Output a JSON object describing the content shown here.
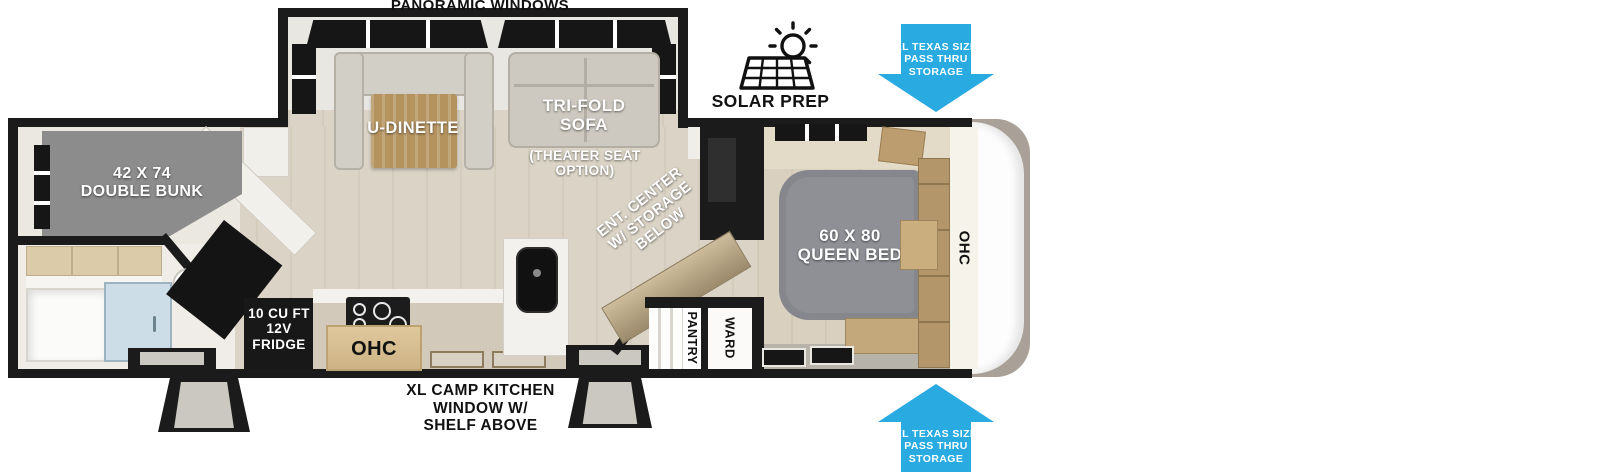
{
  "labels": {
    "panoramic_windows": "PANORAMIC WINDOWS",
    "solar_prep": "SOLAR PREP",
    "pass_thru": [
      "XL TEXAS SIZE",
      "PASS THRU",
      "STORAGE"
    ],
    "camp_kitchen": [
      "XL CAMP KITCHEN",
      "WINDOW W/",
      "SHELF ABOVE"
    ],
    "double_bunk": [
      "42 X 74",
      "DOUBLE BUNK"
    ],
    "u_dinette": "U-DINETTE",
    "tri_fold_sofa": [
      "TRI-FOLD",
      "SOFA"
    ],
    "theater_seat": [
      "(THEATER SEAT",
      "OPTION)"
    ],
    "ent_center": [
      "ENT. CENTER",
      "W/ STORAGE",
      "BELOW"
    ],
    "queen_bed": [
      "60 X 80",
      "QUEEN BED"
    ],
    "ohc_bedroom": "OHC",
    "ohc_kitchen": "OHC",
    "pantry": "PANTRY",
    "ward": "WARD",
    "fridge": [
      "10 CU FT",
      "12V",
      "FRIDGE"
    ]
  },
  "icons": {
    "solar_panel": "solar-panel-icon",
    "sun": "sun-icon",
    "storage_arrow_down": "arrow-down-icon",
    "storage_arrow_up": "arrow-up-icon"
  },
  "colors": {
    "accent_blue": "#29ABE2",
    "wall_black": "#1b1b1b",
    "floor_beige": "#dbd4c6",
    "furniture_gray": "#8c8c8c",
    "bed_gray": "#85878d",
    "wood_tan": "#b5935f",
    "cap_taupe": "#a9a197",
    "glass_blue": "#ccdde7"
  }
}
